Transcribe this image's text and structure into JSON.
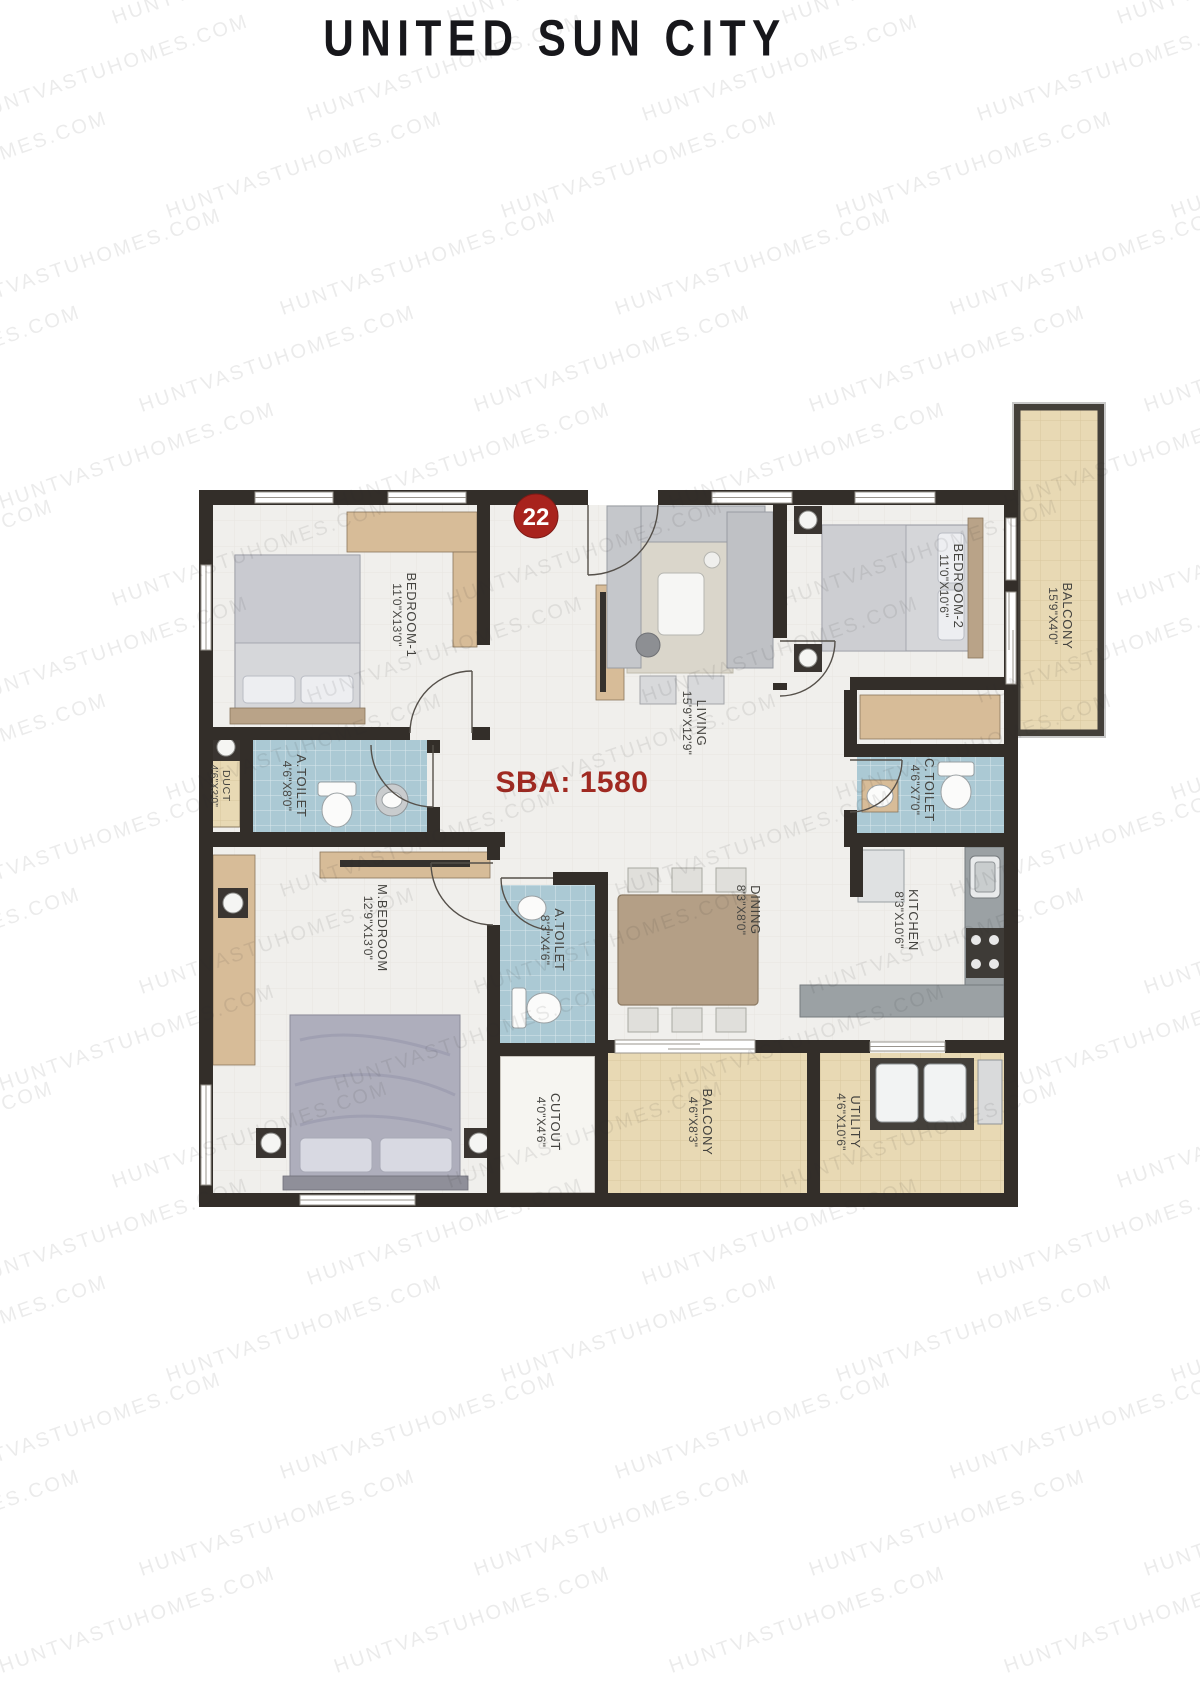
{
  "page": {
    "title": "UNITED SUN CITY",
    "watermark": "HUNTVASTUHOMES.COM"
  },
  "plan": {
    "unit_number": "22",
    "sba_label": "SBA: 1580",
    "rooms": [
      {
        "id": "bedroom1",
        "name": "BEDROOM-1",
        "dims": "11'0\"X13'0\""
      },
      {
        "id": "living",
        "name": "LIVING",
        "dims": "15'9\"X12'9\""
      },
      {
        "id": "bedroom2",
        "name": "BEDROOM-2",
        "dims": "11'0\"X10'6\""
      },
      {
        "id": "balcony_right",
        "name": "BALCONY",
        "dims": "15'9\"X4'0\""
      },
      {
        "id": "duct",
        "name": "DUCT",
        "dims": "4'6\"X2'0\""
      },
      {
        "id": "a_toilet_1",
        "name": "A.TOILET",
        "dims": "4'6\"X8'0\""
      },
      {
        "id": "c_toilet",
        "name": "C.TOILET",
        "dims": "4'6\"X7'0\""
      },
      {
        "id": "m_bedroom",
        "name": "M.BEDROOM",
        "dims": "12'9\"X13'0\""
      },
      {
        "id": "a_toilet_2",
        "name": "A.TOILET",
        "dims": "8'3\"X4'6\""
      },
      {
        "id": "dining",
        "name": "DINING",
        "dims": "8'3\"X8'0\""
      },
      {
        "id": "kitchen",
        "name": "KITCHEN",
        "dims": "8'3\"X10'6\""
      },
      {
        "id": "cutout",
        "name": "CUTOUT",
        "dims": "4'0\"X4'6\""
      },
      {
        "id": "balcony_bottom",
        "name": "BALCONY",
        "dims": "4'6\"X8'3\""
      },
      {
        "id": "utility",
        "name": "UTILITY",
        "dims": "4'6\"X10'6\""
      }
    ],
    "colors": {
      "wall": "#332e29",
      "floor": "#f0efec",
      "toilet_tile": "#abc9d4",
      "deck": "#e8d9b4",
      "accent_red": "#a8231d",
      "sba_red": "#a02a22"
    }
  }
}
